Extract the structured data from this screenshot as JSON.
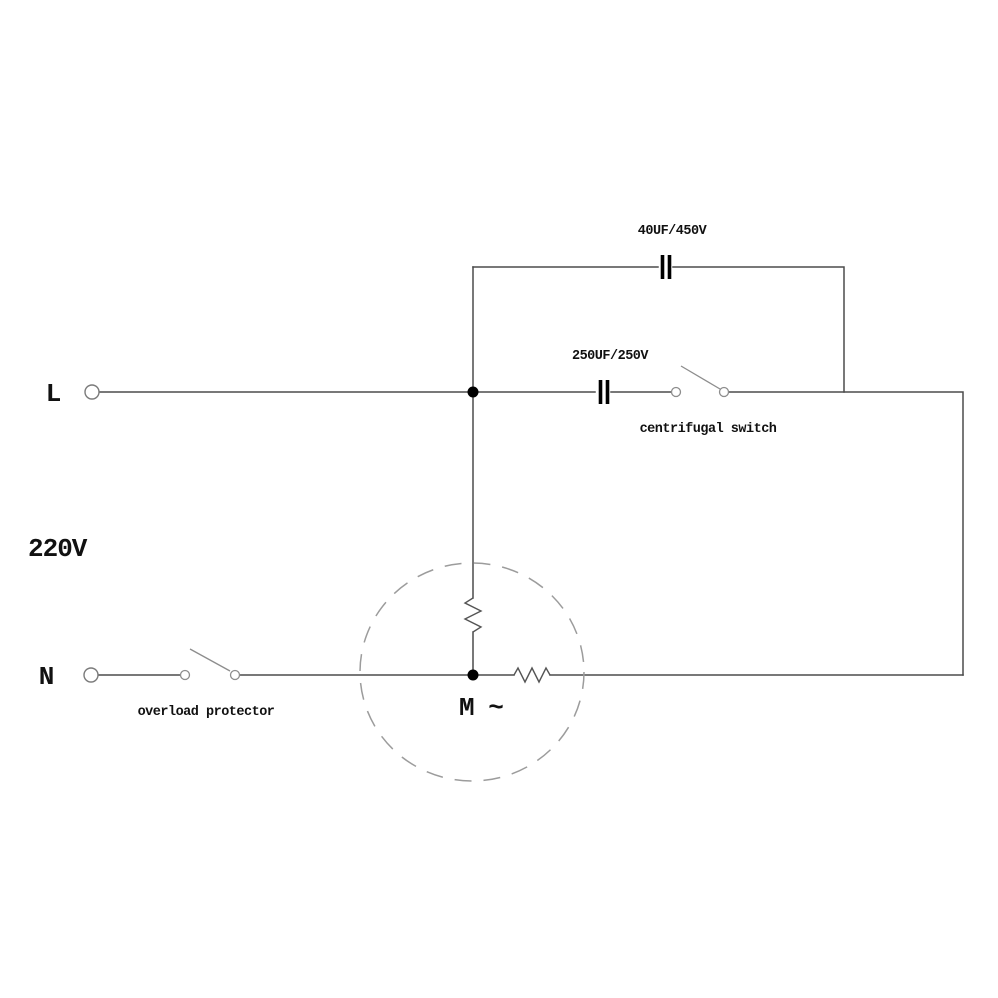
{
  "colors": {
    "background": "#ffffff",
    "wire": "#4b4b4b",
    "component": "#000000",
    "switch": "#8d8d8d",
    "terminal": "#7a7a7a",
    "motor_outline": "#9c9c9c",
    "text": "#111111"
  },
  "labels": {
    "line_terminal": "L",
    "neutral_terminal": "N",
    "supply_voltage": "220V",
    "run_capacitor": "40UF/450V",
    "start_capacitor": "250UF/250V",
    "centrifugal_switch": "centrifugal switch",
    "overload_protector": "overload protector",
    "motor": "M ~"
  }
}
